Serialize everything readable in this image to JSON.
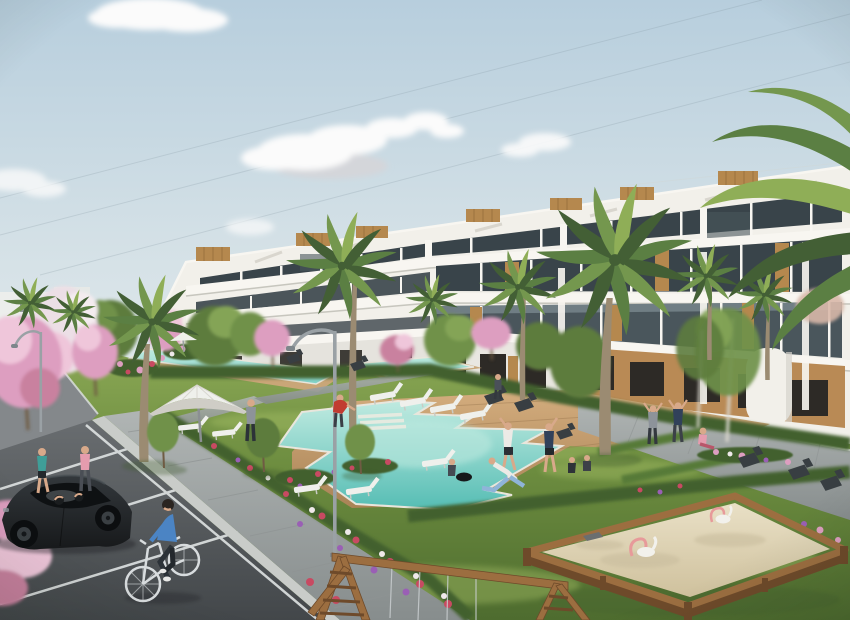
{
  "meta": {
    "description": "Architectural rendering of a white stepped apartment complex with roof terraces, palm trees, lagoon-style swimming pools with wooden decks, a white parasol, sun loungers, lawns with pink blossom trees and flower beds, a parking lot with a dark parked car, a man cycling, pedestrians, people exercising on the grass, a wooden swing frame and a large sandbox with pink spring riders under a pale blue sky with soft clouds."
  },
  "palette": {
    "sky_top": "#b7cedd",
    "sky_mid": "#d3e0e6",
    "sky_low": "#e9eeee",
    "cloud_white": "#fbfbfb",
    "cloud_shadow": "#d4d6da",
    "cable": "#7b8e99",
    "distant_white": "#eceeec",
    "bldg_white": "#f2f0ea",
    "bldg_bright": "#f8f6f1",
    "bldg_shadow": "#bcbbb3",
    "glass_dark": "#39444a",
    "glass_mid": "#4a565c",
    "glass_light": "#6b7d85",
    "railing": "#a9bcc0",
    "wood": "#b5884e",
    "wood_dark": "#8f6a3a",
    "ochre": "#b98a55",
    "opening_dark": "#2d2a26",
    "palm_dark": "#435f35",
    "palm_mid": "#5b7f43",
    "palm_light": "#74974e",
    "palm_pale": "#8fae57",
    "trunk": "#9b8b72",
    "tree_green": "#5d7c3d",
    "tree_mid": "#6f9149",
    "tree_light": "#84a457",
    "trunk_brown": "#6f5b43",
    "blossom_pink": "#dd9ec0",
    "blossom_light": "#efc6da",
    "blossom_deep": "#c9819f",
    "blossom_white": "#ecdfe6",
    "grass_light": "#8ba855",
    "grass_mid": "#6c8c3f",
    "grass_dark": "#4e6c2f",
    "grass_streak": "#a8c168",
    "hedge": "#42612f",
    "hedge_light": "#567a38",
    "pool_pale": "#bfeae0",
    "pool_mid": "#7fd2c8",
    "pool_deep": "#55bdb4",
    "pool_rim": "#e9e6dc",
    "deck_light": "#d4ad7e",
    "deck_dark": "#a98356",
    "deck_line": "#9c7850",
    "paver_light": "#b0b5b4",
    "paver_dark": "#878d8d",
    "paver_joint": "#8f9494",
    "kerb": "#c9ccc9",
    "asphalt_light": "#696d70",
    "asphalt_dark": "#43474a",
    "line_white": "#dfe3e3",
    "sand_light": "#e9e0c6",
    "sand_dark": "#cfc19d",
    "frame_wood": "#9c6e40",
    "frame_wood_dark": "#6e4a2a",
    "lamp_grey": "#9aa1a5",
    "bench_dark": "#383e42",
    "lounger_white": "#eff0ec",
    "car_body": "#17191b",
    "car_top": "#33383c",
    "car_glass": "#0e1113",
    "car_reflect": "#9aa3a8",
    "bike_silver": "#d8dcde",
    "skin": "#d8a98a",
    "teal_top": "#3f9e98",
    "pink_top": "#e59cae",
    "red_shirt": "#c13c31",
    "navy": "#31415a",
    "white_shirt": "#eceae6",
    "blue_shirt": "#4b84c4",
    "dark_pants": "#2c3238",
    "grey_top": "#8d939a",
    "lightblue": "#8fb4d8",
    "toy_pink": "#e79a9a",
    "toy_white": "#f2f1ec"
  },
  "scene": {
    "sky": {
      "clouds": 6,
      "power_lines": 3
    },
    "buildings": {
      "main": {
        "floors": 4,
        "style": "stepped white terraces, dark glazing, wood slat accents",
        "rooftop_wood_boxes": 7
      },
      "distant_left": 2
    },
    "vegetation": {
      "palm_trees": 10,
      "blossom_trees": 8,
      "green_trees": 9,
      "small_lawn_trees": 3,
      "hedges": 4,
      "flower_beds": 8
    },
    "water": {
      "main_pool": 1,
      "lap_pool_segments": 2
    },
    "amenities": {
      "umbrellas": 2,
      "sun_loungers": 9,
      "benches": 8,
      "street_lamps": 2,
      "sandbox": 1,
      "spring_riders": 2,
      "swing_frame": 1
    },
    "people": {
      "total": 16,
      "cyclist": 1,
      "walking": 3,
      "exercising": 4,
      "sitting": 4,
      "arms_raised": 2,
      "car_occupants": 2
    },
    "vehicles": {
      "parked_car": 1,
      "distant_car": 1
    }
  }
}
